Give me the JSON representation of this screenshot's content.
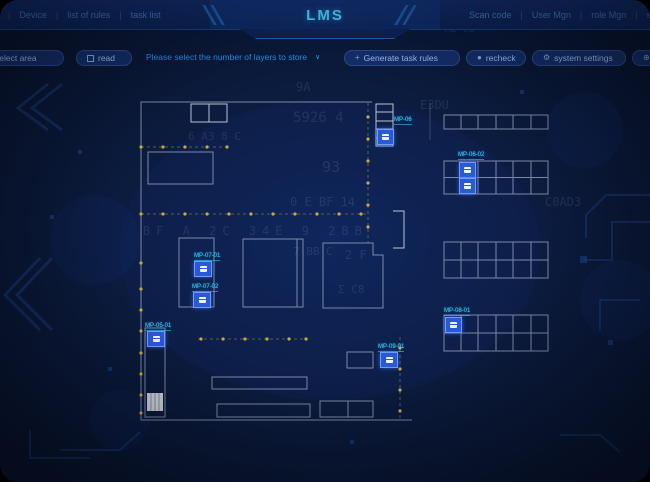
{
  "header": {
    "title": "LMS",
    "menu_left": [
      "Device",
      "list of rules",
      "task list"
    ],
    "menu_right": [
      "Scan code",
      "User Mgn",
      "role Mgn",
      "set"
    ]
  },
  "toolbar": {
    "select_area": "select area",
    "read": "read",
    "hint": "Please select the number of layers to store",
    "caret": "∨",
    "generate_rules": "Generate task rules",
    "generate_icon": "+",
    "recheck": "recheck",
    "recheck_icon": "●",
    "system_settings": "system settings",
    "settings_icon": "⚙",
    "cad_settings": "CAD drawing set",
    "cad_icon": "⊕"
  },
  "markers": {
    "rack_top": "MP-06",
    "rack_b": "MP-06-02",
    "room_a1": "MP-07-01",
    "room_a2": "MP-07-02",
    "left_col": "MP-05-01",
    "center": "MP-09-01",
    "rack_d": "MP-08-01"
  },
  "decor": [
    "9A",
    "A 7",
    "5926 4",
    "E3DU",
    "6 A3 8 C",
    "93",
    "0 E BF 14",
    "BF A 2C 34E 9 2BB",
    "C0AD3",
    "7 BB C",
    "2 F",
    "Σ C8",
    "A2 08"
  ],
  "colors": {
    "accent": "#45c8f5",
    "marker_blue": "#2a59d6",
    "label_cyan": "#3fd4ff",
    "dot_yellow": "#c9a93f",
    "plan_line": "#98a2c0"
  }
}
